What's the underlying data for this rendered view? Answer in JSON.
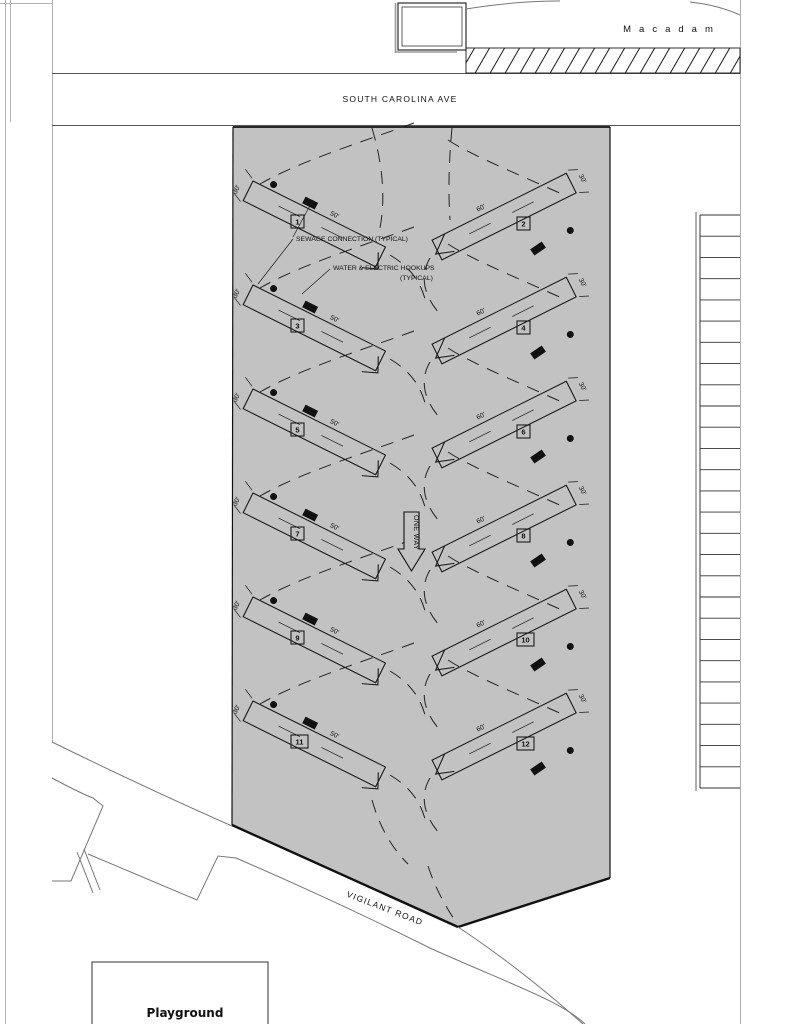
{
  "streets": {
    "top": "SOUTH CAROLINA AVE",
    "right": "Macadam",
    "bottom": "VIGILANT ROAD"
  },
  "areas": {
    "playground_label": "Playground",
    "one_way_label": "ONE WAY"
  },
  "callouts": {
    "sewage": "SEWAGE CONNECTION (TYPICAL)",
    "water_line1": "WATER & ELECTRIC HOOKUPS",
    "water_line2": "(TYPICAL)"
  },
  "sites": [
    {
      "number": "1",
      "column": "left",
      "row": 0,
      "width_label": "30'",
      "length_label": "50'"
    },
    {
      "number": "2",
      "column": "right",
      "row": 0,
      "width_label": "30'",
      "length_label": "60'"
    },
    {
      "number": "3",
      "column": "left",
      "row": 1,
      "width_label": "30'",
      "length_label": "50'"
    },
    {
      "number": "4",
      "column": "right",
      "row": 1,
      "width_label": "30'",
      "length_label": "60'"
    },
    {
      "number": "5",
      "column": "left",
      "row": 2,
      "width_label": "30'",
      "length_label": "50'"
    },
    {
      "number": "6",
      "column": "right",
      "row": 2,
      "width_label": "30'",
      "length_label": "60'"
    },
    {
      "number": "7",
      "column": "left",
      "row": 3,
      "width_label": "30'",
      "length_label": "50'"
    },
    {
      "number": "8",
      "column": "right",
      "row": 3,
      "width_label": "30'",
      "length_label": "60'"
    },
    {
      "number": "9",
      "column": "left",
      "row": 4,
      "width_label": "30'",
      "length_label": "50'"
    },
    {
      "number": "10",
      "column": "right",
      "row": 4,
      "width_label": "30'",
      "length_label": "60'"
    },
    {
      "number": "11",
      "column": "left",
      "row": 5,
      "width_label": "30'",
      "length_label": "50'"
    },
    {
      "number": "12",
      "column": "right",
      "row": 5,
      "width_label": "30'",
      "length_label": "60'"
    }
  ],
  "parking": {
    "stall_count": 27
  },
  "colors": {
    "campground_fill": "#c2c2c2",
    "line": "#1a1a1a",
    "road_line": "#777777"
  }
}
